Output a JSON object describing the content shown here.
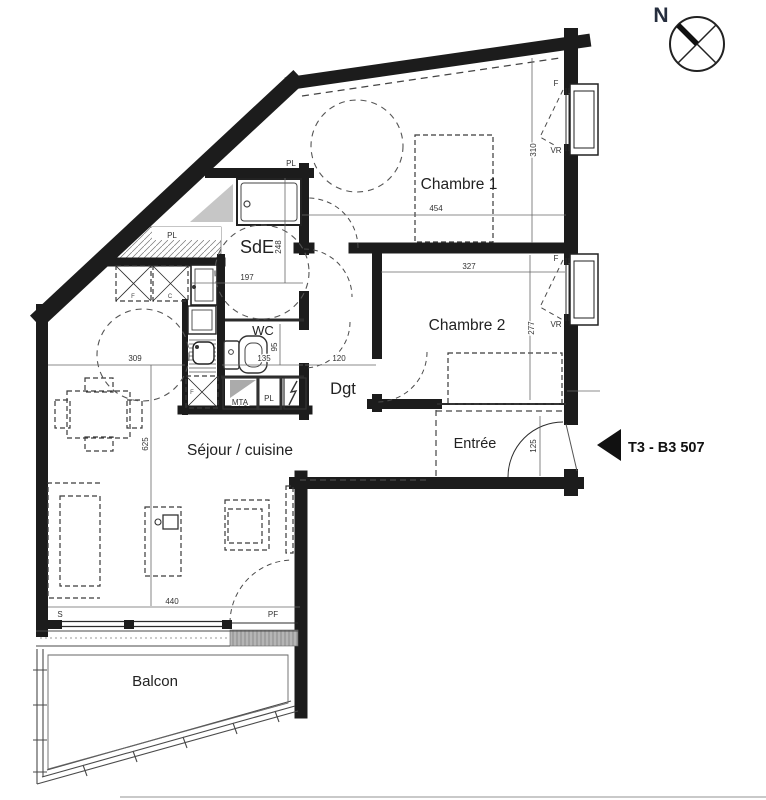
{
  "unit": {
    "label": "T3 - B3 507"
  },
  "compass": {
    "north": "N"
  },
  "rooms": {
    "chambre1": "Chambre 1",
    "chambre2": "Chambre 2",
    "sde": "SdE",
    "wc": "WC",
    "dgt": "Dgt",
    "sejour": "Séjour / cuisine",
    "entree": "Entrée",
    "balcon": "Balcon"
  },
  "fixtures": {
    "pl": "PL",
    "mta": "MTA",
    "f": "F",
    "c": "C",
    "vr": "VR",
    "s": "S",
    "pf": "PF"
  },
  "dims": {
    "chambre1_w": "454",
    "chambre1_d": "310",
    "chambre2_w": "327",
    "chambre2_d": "277",
    "sde_w": "197",
    "sde_d": "248",
    "wc_w": "135",
    "wc_d": "95",
    "dgt_w": "120",
    "kitchen_w": "309",
    "sejour_d": "625",
    "sejour_w": "440",
    "entree_d": "125"
  },
  "colors": {
    "wall": "#1c1c1c",
    "north_letter": "#262e3e"
  }
}
